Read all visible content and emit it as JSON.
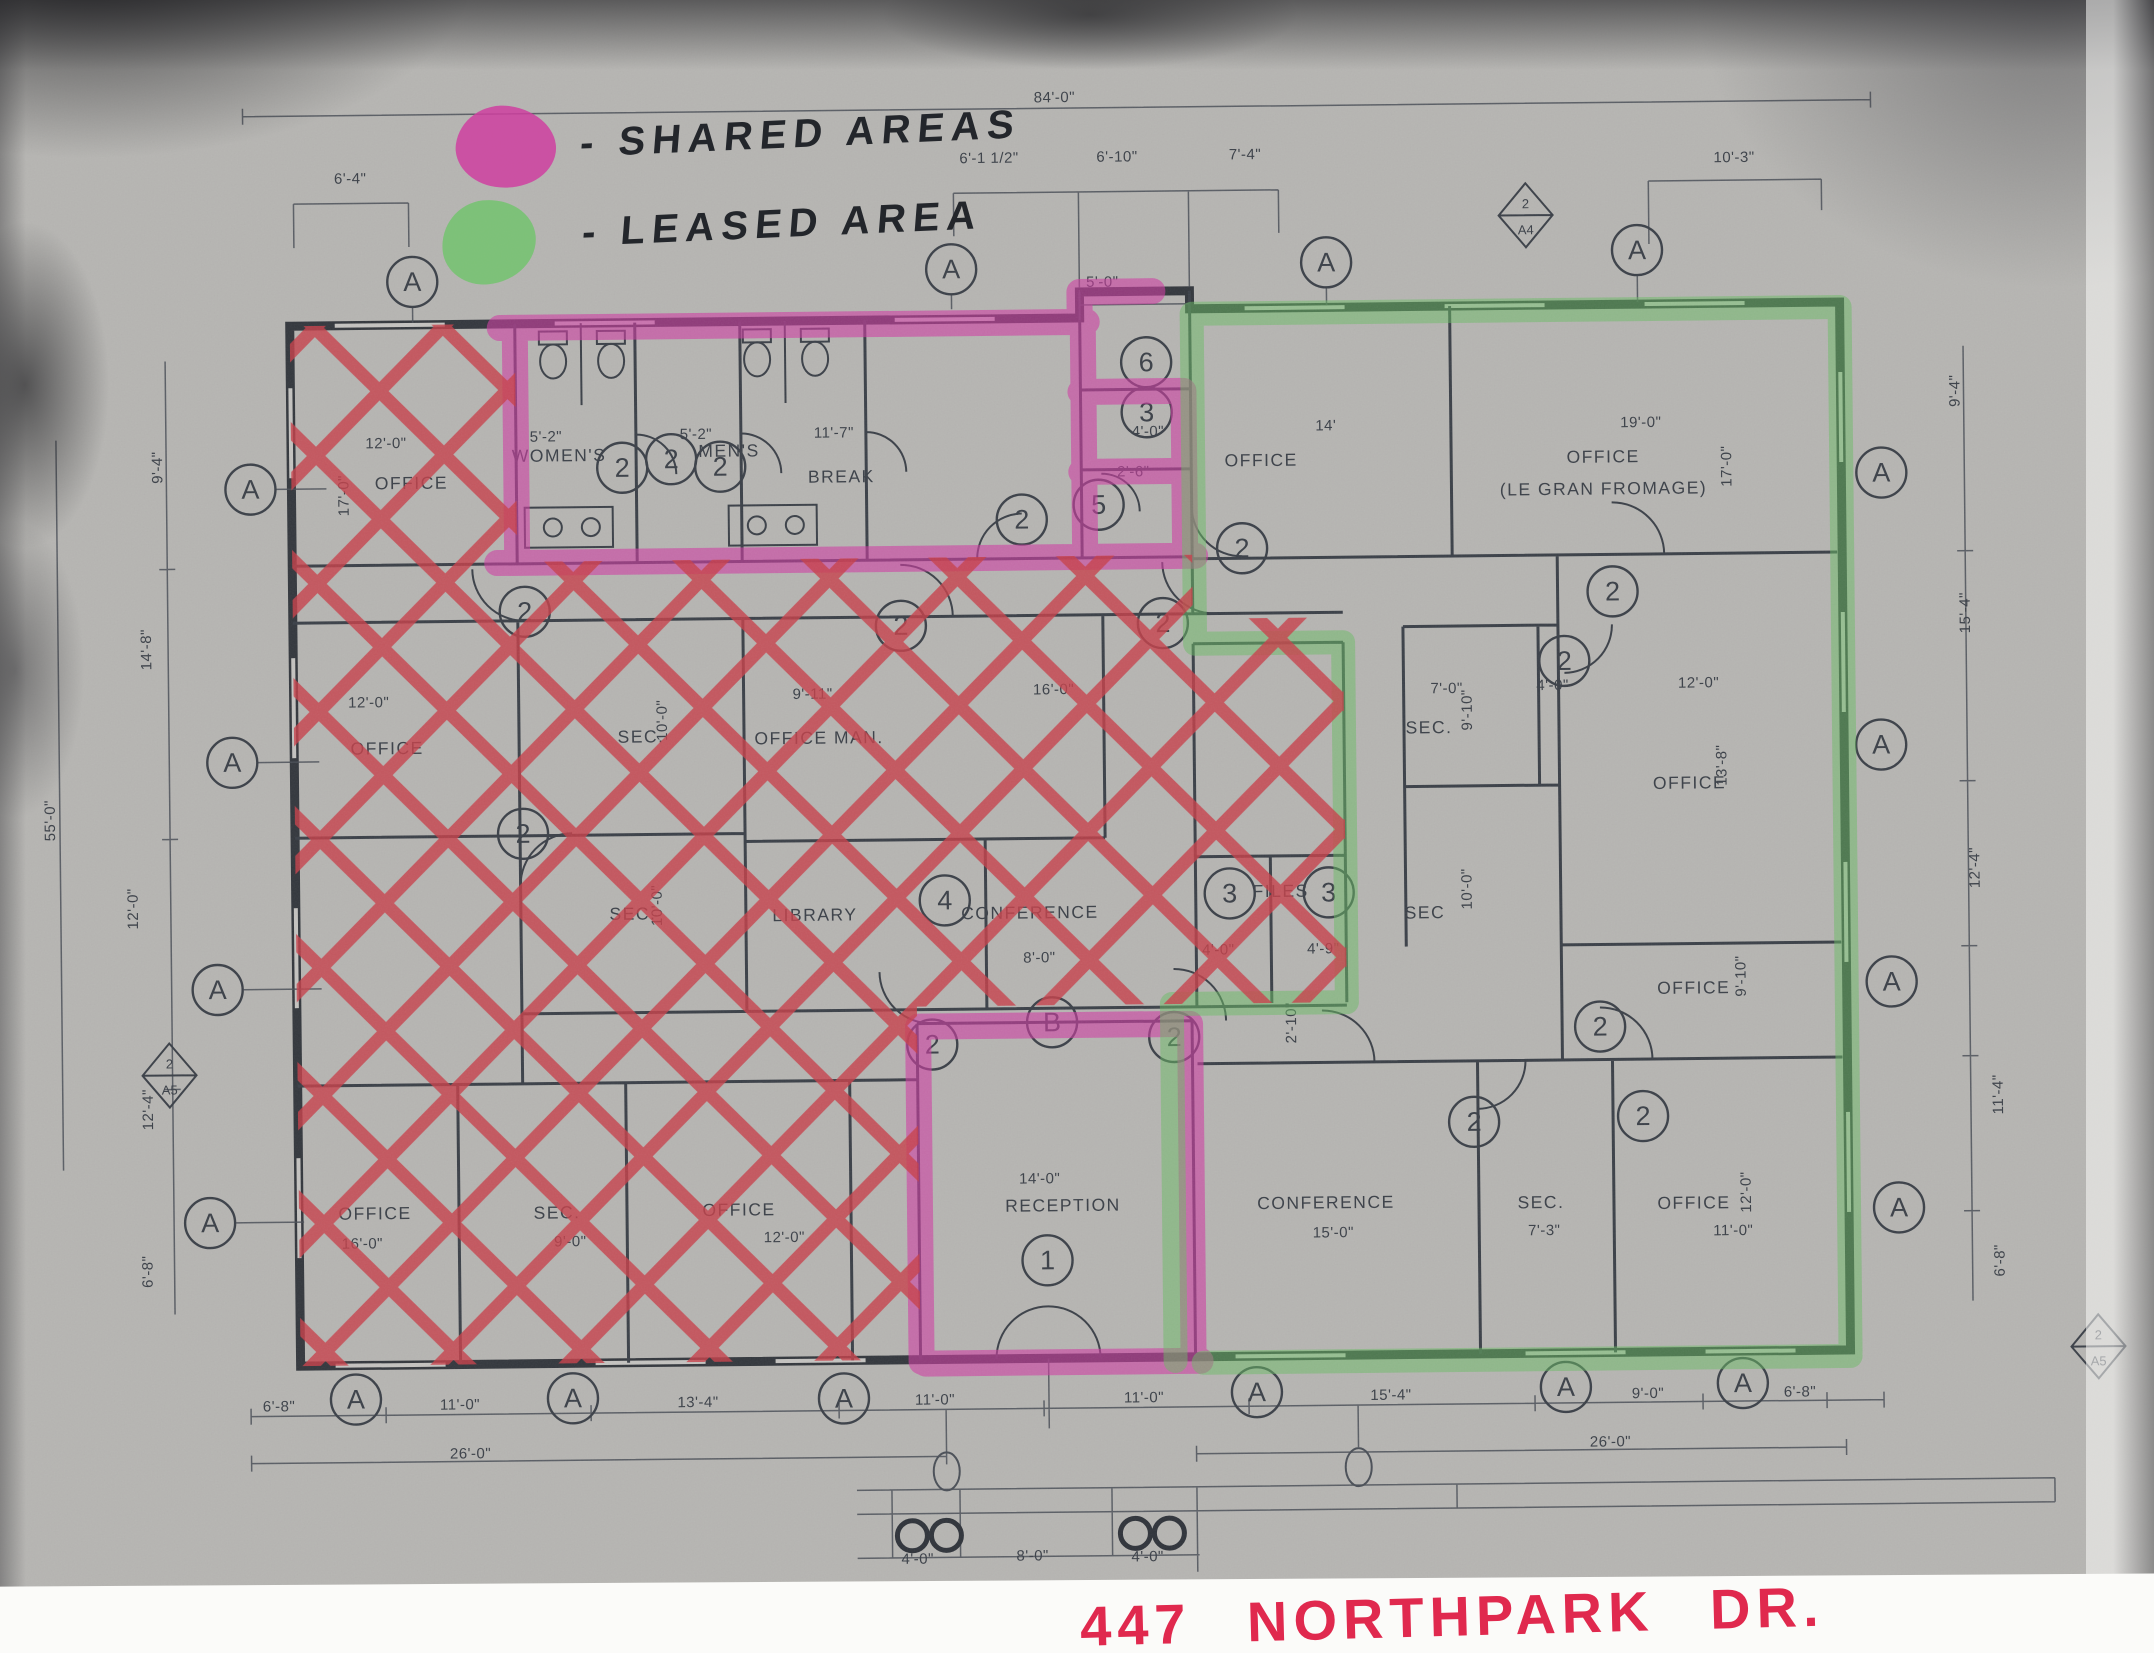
{
  "legend": {
    "shared_label": "- SHARED AREAS",
    "leased_label": "- LEASED AREA",
    "shared_color": "#cf3fa0",
    "leased_color": "#6fc46a"
  },
  "address": "447 NORTHPARK DR.",
  "colors": {
    "crosshatch": "#c8404a",
    "shared_highlight": "#cf3ea4",
    "leased_highlight": "#69bc64",
    "address_red": "#e0294e",
    "plan_line": "#3b4048",
    "paper": "#b6b5b2"
  },
  "plan": {
    "rooms": [
      {
        "t": "OFFICE",
        "x": 415,
        "y": 482
      },
      {
        "t": "WOMEN'S",
        "x": 563,
        "y": 456
      },
      {
        "t": "MEN'S",
        "x": 733,
        "y": 453
      },
      {
        "t": "BREAK",
        "x": 845,
        "y": 480
      },
      {
        "t": "OFFICE",
        "x": 1265,
        "y": 468
      },
      {
        "t": "OFFICE",
        "x": 1607,
        "y": 468
      },
      {
        "t": "(LE GRAN FROMAGE)",
        "x": 1607,
        "y": 500
      },
      {
        "t": "OFFICE",
        "x": 388,
        "y": 747
      },
      {
        "t": "SEC.",
        "x": 642,
        "y": 738
      },
      {
        "t": "OFFICE MAN.",
        "x": 820,
        "y": 741
      },
      {
        "t": "SEC.",
        "x": 632,
        "y": 915
      },
      {
        "t": "LIBRARY",
        "x": 814,
        "y": 918
      },
      {
        "t": "CONFERENCE",
        "x": 1029,
        "y": 918
      },
      {
        "t": "FILES",
        "x": 1280,
        "y": 899
      },
      {
        "t": "SEC",
        "x": 1424,
        "y": 922
      },
      {
        "t": "SEC.",
        "x": 1430,
        "y": 737
      },
      {
        "t": "OFFICE",
        "x": 1690,
        "y": 795
      },
      {
        "t": "OFFICE",
        "x": 1692,
        "y": 1000
      },
      {
        "t": "OFFICE",
        "x": 371,
        "y": 1212
      },
      {
        "t": "SEC.",
        "x": 553,
        "y": 1213
      },
      {
        "t": "OFFICE",
        "x": 735,
        "y": 1212
      },
      {
        "t": "RECEPTION",
        "x": 1059,
        "y": 1211
      },
      {
        "t": "CONFERENCE",
        "x": 1322,
        "y": 1211
      },
      {
        "t": "SEC.",
        "x": 1537,
        "y": 1213
      },
      {
        "t": "OFFICE",
        "x": 1690,
        "y": 1215
      }
    ],
    "dims": [
      {
        "t": "84'-0\"",
        "x": 1062,
        "y": 102
      },
      {
        "t": "6'-4\"",
        "x": 357,
        "y": 176
      },
      {
        "t": "6'-1 1/2\"",
        "x": 996,
        "y": 162
      },
      {
        "t": "6'-10\"",
        "x": 1124,
        "y": 162
      },
      {
        "t": "7'-4\"",
        "x": 1252,
        "y": 161
      },
      {
        "t": "10'-3\"",
        "x": 1741,
        "y": 169
      },
      {
        "t": "5'-0\"",
        "x": 1108,
        "y": 287
      },
      {
        "t": "5'-2\"",
        "x": 550,
        "y": 436
      },
      {
        "t": "5'-2\"",
        "x": 700,
        "y": 435
      },
      {
        "t": "11'-7\"",
        "x": 838,
        "y": 435
      },
      {
        "t": "4'-0\"",
        "x": 1152,
        "y": 437
      },
      {
        "t": "2'-6\"",
        "x": 1137,
        "y": 477
      },
      {
        "t": "14'",
        "x": 1330,
        "y": 433
      },
      {
        "t": "19'-0\"",
        "x": 1645,
        "y": 433
      },
      {
        "t": "17'-0\"",
        "x": 1735,
        "y": 473,
        "v": 1
      },
      {
        "t": "12'-0\"",
        "x": 390,
        "y": 441
      },
      {
        "t": "17'-0\"",
        "x": 352,
        "y": 488,
        "v": 1
      },
      {
        "t": "12'-0\"",
        "x": 370,
        "y": 700
      },
      {
        "t": "10'-0\"",
        "x": 668,
        "y": 716,
        "v": 1
      },
      {
        "t": "9'-11\"",
        "x": 814,
        "y": 696
      },
      {
        "t": "16'-0\"",
        "x": 1055,
        "y": 694
      },
      {
        "t": "10'-0\"",
        "x": 661,
        "y": 901,
        "v": 1
      },
      {
        "t": "8'-0\"",
        "x": 1038,
        "y": 962
      },
      {
        "t": "4'-0\"",
        "x": 1217,
        "y": 956
      },
      {
        "t": "4'-9\"",
        "x": 1322,
        "y": 956
      },
      {
        "t": "2'-10\"",
        "x": 1294,
        "y": 1025,
        "v": 1
      },
      {
        "t": "7'-0\"",
        "x": 1448,
        "y": 697
      },
      {
        "t": "9'-10\"",
        "x": 1473,
        "y": 714,
        "v": 1
      },
      {
        "t": "4'-0\"",
        "x": 1554,
        "y": 695
      },
      {
        "t": "12'-0\"",
        "x": 1700,
        "y": 694
      },
      {
        "t": "13'-8\"",
        "x": 1727,
        "y": 772,
        "v": 1
      },
      {
        "t": "10'-0\"",
        "x": 1471,
        "y": 893,
        "v": 1
      },
      {
        "t": "9'-10\"",
        "x": 1744,
        "y": 983,
        "v": 1
      },
      {
        "t": "14'-0\"",
        "x": 1036,
        "y": 1183
      },
      {
        "t": "15'-0\"",
        "x": 1329,
        "y": 1240
      },
      {
        "t": "7'-3\"",
        "x": 1540,
        "y": 1240
      },
      {
        "t": "11'-0\"",
        "x": 1729,
        "y": 1242
      },
      {
        "t": "12'-0\"",
        "x": 1747,
        "y": 1199,
        "v": 1
      },
      {
        "t": "16'-0\"",
        "x": 358,
        "y": 1241
      },
      {
        "t": "9'-0\"",
        "x": 566,
        "y": 1241
      },
      {
        "t": "12'-0\"",
        "x": 780,
        "y": 1239
      },
      {
        "t": "6'-8\"",
        "x": 273,
        "y": 1403
      },
      {
        "t": "11'-0\"",
        "x": 454,
        "y": 1403
      },
      {
        "t": "13'-4\"",
        "x": 692,
        "y": 1403
      },
      {
        "t": "11'-0\"",
        "x": 929,
        "y": 1403
      },
      {
        "t": "11'-0\"",
        "x": 1138,
        "y": 1403
      },
      {
        "t": "15'-4\"",
        "x": 1385,
        "y": 1403
      },
      {
        "t": "9'-0\"",
        "x": 1642,
        "y": 1404
      },
      {
        "t": "6'-8\"",
        "x": 1794,
        "y": 1404
      },
      {
        "t": "26'-0\"",
        "x": 464,
        "y": 1452
      },
      {
        "t": "26'-0\"",
        "x": 1604,
        "y": 1452
      },
      {
        "t": "4'-0\"",
        "x": 910,
        "y": 1562
      },
      {
        "t": "8'-0\"",
        "x": 1025,
        "y": 1560
      },
      {
        "t": "4'-0\"",
        "x": 1140,
        "y": 1562
      },
      {
        "t": "9'-4\"",
        "x": 166,
        "y": 458,
        "v": 1
      },
      {
        "t": "14'-8\"",
        "x": 153,
        "y": 640,
        "v": 1
      },
      {
        "t": "12'-0\"",
        "x": 137,
        "y": 899,
        "v": 1
      },
      {
        "t": "12'-4\"",
        "x": 150,
        "y": 1100,
        "v": 1
      },
      {
        "t": "6'-8\"",
        "x": 148,
        "y": 1262,
        "v": 1
      },
      {
        "t": "55'-0\"",
        "x": 55,
        "y": 810,
        "v": 1
      },
      {
        "t": "9'-4\"",
        "x": 1964,
        "y": 400,
        "v": 1
      },
      {
        "t": "15'-4\"",
        "x": 1972,
        "y": 622,
        "v": 1
      },
      {
        "t": "12'-4\"",
        "x": 1979,
        "y": 877,
        "v": 1
      },
      {
        "t": "11'-4\"",
        "x": 2000,
        "y": 1104,
        "v": 1
      },
      {
        "t": "6'-8\"",
        "x": 2000,
        "y": 1270,
        "v": 1
      }
    ],
    "markers": [
      {
        "t": "A",
        "x": 418,
        "y": 275
      },
      {
        "t": "A",
        "x": 957,
        "y": 268
      },
      {
        "t": "A",
        "x": 1332,
        "y": 265
      },
      {
        "t": "A",
        "x": 1643,
        "y": 256
      },
      {
        "t": "A",
        "x": 254,
        "y": 481
      },
      {
        "t": "A",
        "x": 233,
        "y": 754
      },
      {
        "t": "A",
        "x": 216,
        "y": 981
      },
      {
        "t": "A",
        "x": 206,
        "y": 1214
      },
      {
        "t": "A",
        "x": 1885,
        "y": 481
      },
      {
        "t": "A",
        "x": 1882,
        "y": 753
      },
      {
        "t": "A",
        "x": 1890,
        "y": 990
      },
      {
        "t": "A",
        "x": 1895,
        "y": 1216
      },
      {
        "t": "A",
        "x": 350,
        "y": 1392
      },
      {
        "t": "A",
        "x": 567,
        "y": 1393
      },
      {
        "t": "A",
        "x": 838,
        "y": 1396
      },
      {
        "t": "A",
        "x": 1251,
        "y": 1394
      },
      {
        "t": "A",
        "x": 1560,
        "y": 1392
      },
      {
        "t": "A",
        "x": 1737,
        "y": 1390
      },
      {
        "t": "2",
        "x": 626,
        "y": 463
      },
      {
        "t": "2",
        "x": 675,
        "y": 455
      },
      {
        "t": "2",
        "x": 724,
        "y": 463
      },
      {
        "t": "2",
        "x": 1025,
        "y": 519
      },
      {
        "t": "2",
        "x": 527,
        "y": 606
      },
      {
        "t": "2",
        "x": 523,
        "y": 828
      },
      {
        "t": "2",
        "x": 903,
        "y": 624
      },
      {
        "t": "2",
        "x": 1165,
        "y": 624
      },
      {
        "t": "2",
        "x": 1245,
        "y": 550
      },
      {
        "t": "2",
        "x": 1615,
        "y": 597
      },
      {
        "t": "2",
        "x": 1566,
        "y": 666
      },
      {
        "t": "2",
        "x": 1598,
        "y": 1032
      },
      {
        "t": "2",
        "x": 1640,
        "y": 1122
      },
      {
        "t": "2",
        "x": 1471,
        "y": 1126
      },
      {
        "t": "2",
        "x": 930,
        "y": 1043
      },
      {
        "t": "2",
        "x": 1172,
        "y": 1038
      },
      {
        "t": "3",
        "x": 1151,
        "y": 413
      },
      {
        "t": "3",
        "x": 1229,
        "y": 895
      },
      {
        "t": "3",
        "x": 1328,
        "y": 895
      },
      {
        "t": "4",
        "x": 944,
        "y": 899
      },
      {
        "t": "5",
        "x": 1102,
        "y": 505
      },
      {
        "t": "6",
        "x": 1151,
        "y": 363
      },
      {
        "t": "B",
        "x": 1050,
        "y": 1022
      },
      {
        "t": "1",
        "x": 1043,
        "y": 1260
      }
    ],
    "diamonds": [
      {
        "top": "2",
        "bottom": "A4",
        "x": 1532,
        "y": 220
      },
      {
        "top": "2",
        "bottom": "A5",
        "x": 2093,
        "y": 1357
      },
      {
        "top": "2",
        "bottom": "A5",
        "x": 167,
        "y": 1066
      }
    ]
  }
}
